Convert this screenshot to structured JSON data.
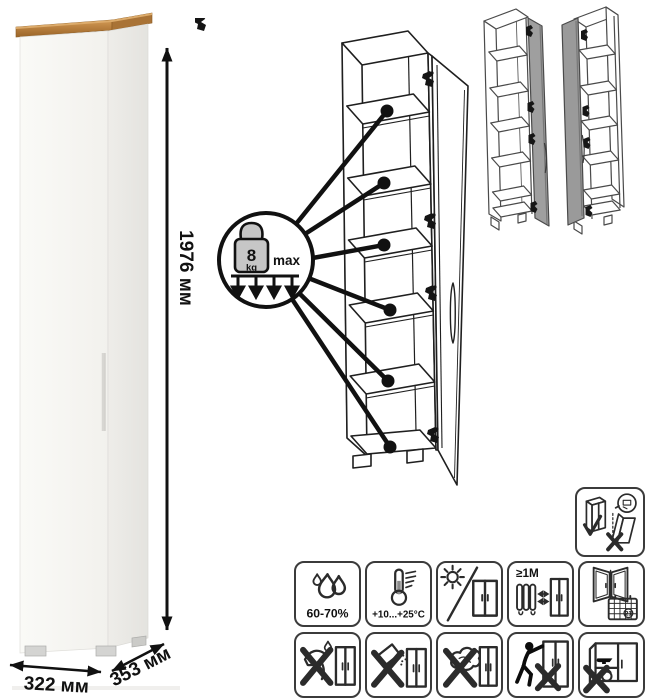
{
  "dimensions": {
    "height": "1976 мм",
    "width": "322 мм",
    "depth": "353 мм"
  },
  "shelf_load": {
    "value": "8",
    "unit": "kg",
    "max": "max"
  },
  "care": {
    "humidity": "60-70%",
    "temperature": "+10...+25°C",
    "min_heat_distance": "≥1M",
    "calendar_day": "21"
  },
  "colors": {
    "wood_top": "#b9803f",
    "cabinet_body": "#f7f6f3",
    "door_gray": "#9d9d9d",
    "line": "#1f1f1f"
  },
  "icons": {
    "badge": "shelf-max-load-8kg",
    "row1": [
      "humidity-icon",
      "temperature-icon",
      "no-direct-sunlight-icon",
      "heat-distance-icon",
      "ventilation-icon"
    ],
    "row2": [
      "no-solvents-icon",
      "no-abrasives-icon",
      "no-wet-cleaning-icon",
      "no-pushing-icon",
      "no-overload-icon"
    ],
    "other": [
      "anti-tip-upright-icon",
      "door-right-variant",
      "door-left-variant"
    ]
  }
}
